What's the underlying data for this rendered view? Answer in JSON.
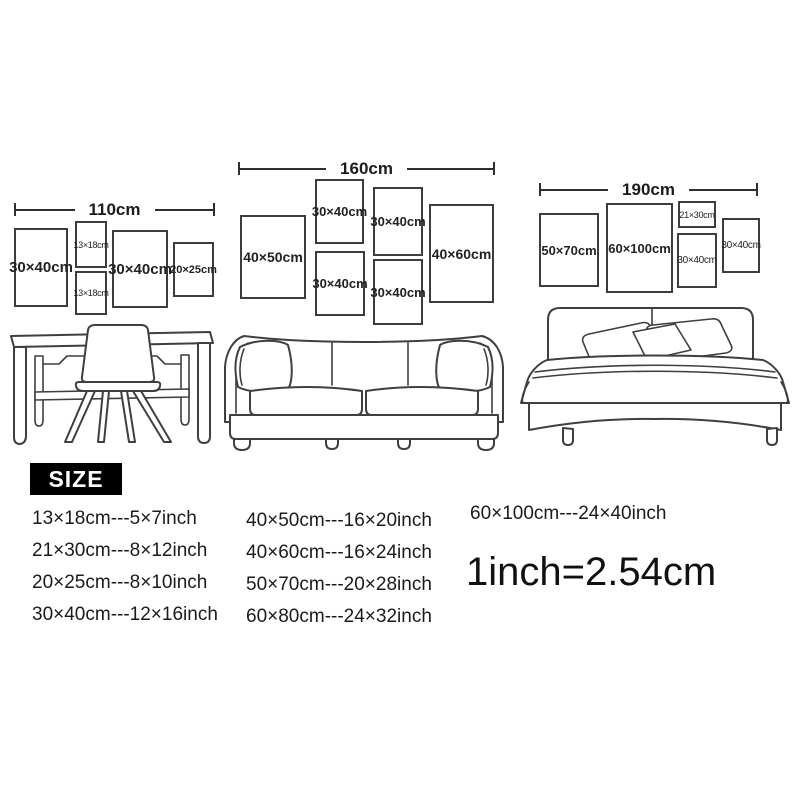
{
  "colors": {
    "background": "#ffffff",
    "line": "#2f2f2f",
    "frame_border": "#3d3d3d",
    "text": "#1b1b1b",
    "badge_bg": "#000000",
    "badge_text": "#ffffff"
  },
  "scenes": [
    {
      "name": "desk",
      "dimension_label": "110cm",
      "frames": [
        {
          "label": "30×40cm"
        },
        {
          "label": "13×18cm"
        },
        {
          "label": "13×18cm"
        },
        {
          "label": "30×40cm"
        },
        {
          "label": "20×25cm"
        }
      ]
    },
    {
      "name": "sofa",
      "dimension_label": "160cm",
      "frames": [
        {
          "label": "40×50cm"
        },
        {
          "label": "30×40cm"
        },
        {
          "label": "30×40cm"
        },
        {
          "label": "30×40cm"
        },
        {
          "label": "30×40cm"
        },
        {
          "label": "40×60cm"
        }
      ]
    },
    {
      "name": "bed",
      "dimension_label": "190cm",
      "frames": [
        {
          "label": "50×70cm"
        },
        {
          "label": "60×100cm"
        },
        {
          "label": "21×30cm"
        },
        {
          "label": "30×40cm"
        },
        {
          "label": "30×40cm"
        }
      ]
    }
  ],
  "size_section": {
    "badge_label": "SIZE",
    "columns": [
      {
        "rows": [
          "13×18cm---5×7inch",
          "21×30cm---8×12inch",
          "20×25cm---8×10inch",
          "30×40cm---12×16inch"
        ]
      },
      {
        "rows": [
          "40×50cm---16×20inch",
          "40×60cm---16×24inch",
          "50×70cm---20×28inch",
          "60×80cm---24×32inch"
        ]
      },
      {
        "rows": [
          "60×100cm---24×40inch"
        ]
      }
    ],
    "conversion_note": "1inch=2.54cm"
  }
}
